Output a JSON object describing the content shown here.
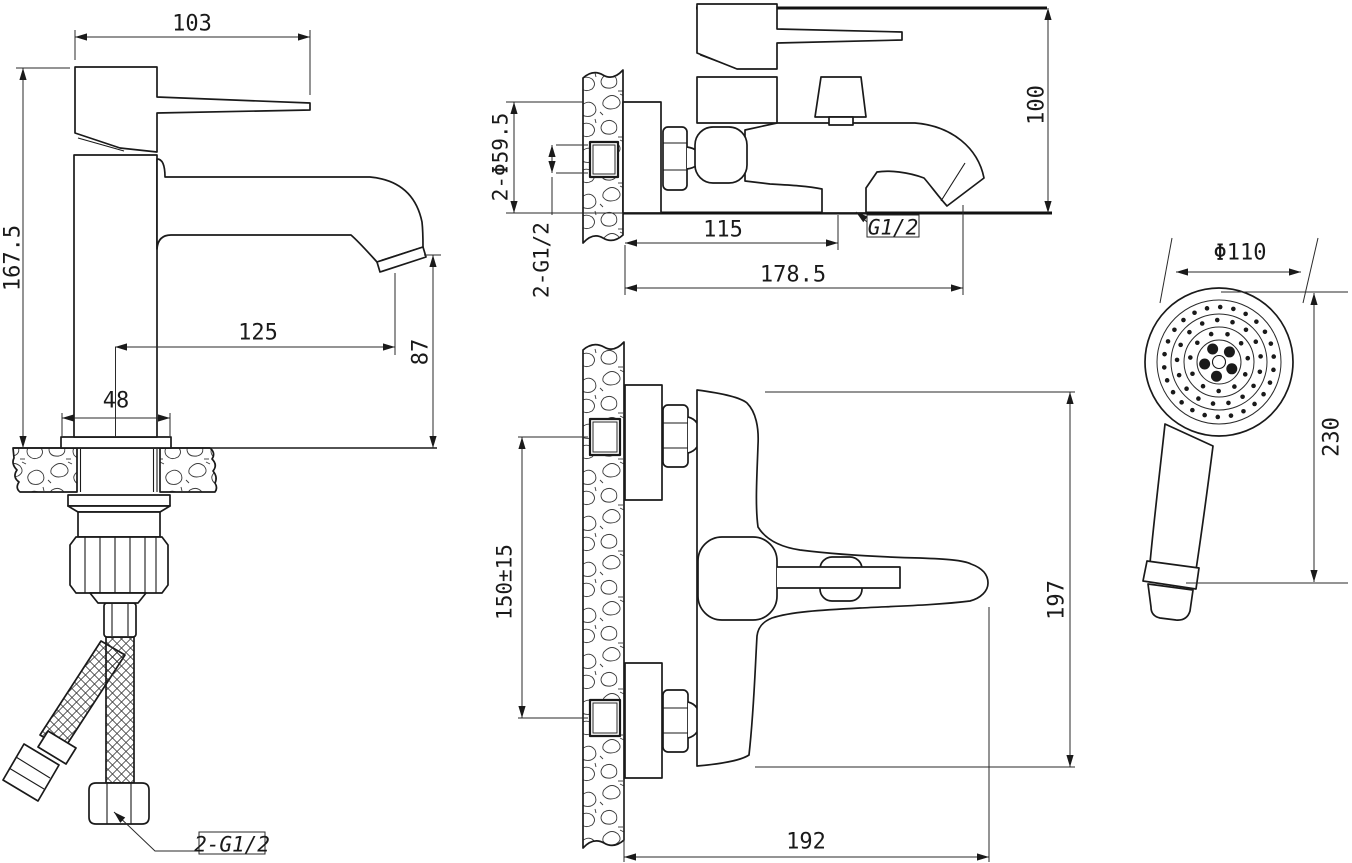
{
  "colors": {
    "background": "#ffffff",
    "line": "#1a1a1a"
  },
  "views": {
    "basin_faucet_side": {
      "dims": {
        "handle_length": "103",
        "total_height": "167.5",
        "spout_reach": "125",
        "spout_height": "87",
        "base_width": "48",
        "supply_hose_thread": "2-G1/2"
      }
    },
    "bath_mixer_side": {
      "dims": {
        "height_above_datum": "100",
        "escutcheon_diameter": "2-Φ59.5",
        "inlet_thread": "2-G1/2",
        "shower_outlet_offset": "115",
        "spout_reach": "178.5",
        "shower_outlet_thread": "G1/2"
      }
    },
    "bath_mixer_front": {
      "dims": {
        "inlet_spacing": "150±15",
        "overall_height": "197",
        "overall_width": "192"
      }
    },
    "hand_shower": {
      "dims": {
        "head_diameter": "Φ110",
        "total_length": "230"
      }
    }
  }
}
